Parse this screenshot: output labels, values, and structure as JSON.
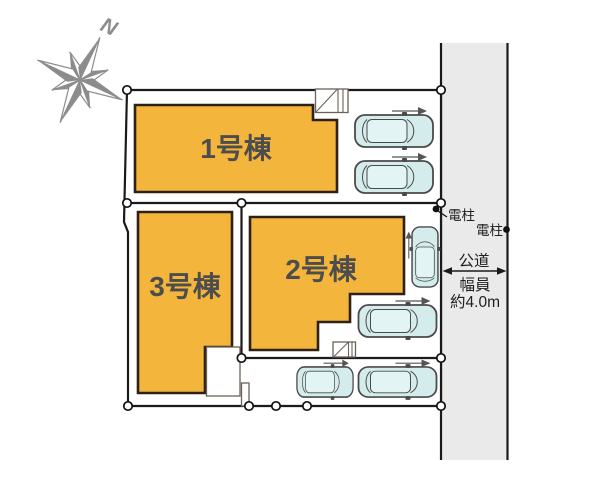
{
  "compass": {
    "north_label": "N"
  },
  "buildings": [
    {
      "label": "1号棟"
    },
    {
      "label": "2号棟"
    },
    {
      "label": "3号棟"
    }
  ],
  "road": {
    "label": "公道",
    "width_caption": "幅員",
    "width_value": "約4.0m"
  },
  "utility_poles": [
    {
      "label": "電柱"
    },
    {
      "label": "電柱"
    }
  ],
  "colors": {
    "building_fill": "#F4B53C",
    "building_border": "#2E2014",
    "car_body": "#D5ECEC",
    "road_fill": "#EAEAEA",
    "boundary_line": "#1A1A1A",
    "compass_gray": "#8C8C8C",
    "building_label_text": "#4D4D4D",
    "annotation_text": "#1F1F1F"
  }
}
